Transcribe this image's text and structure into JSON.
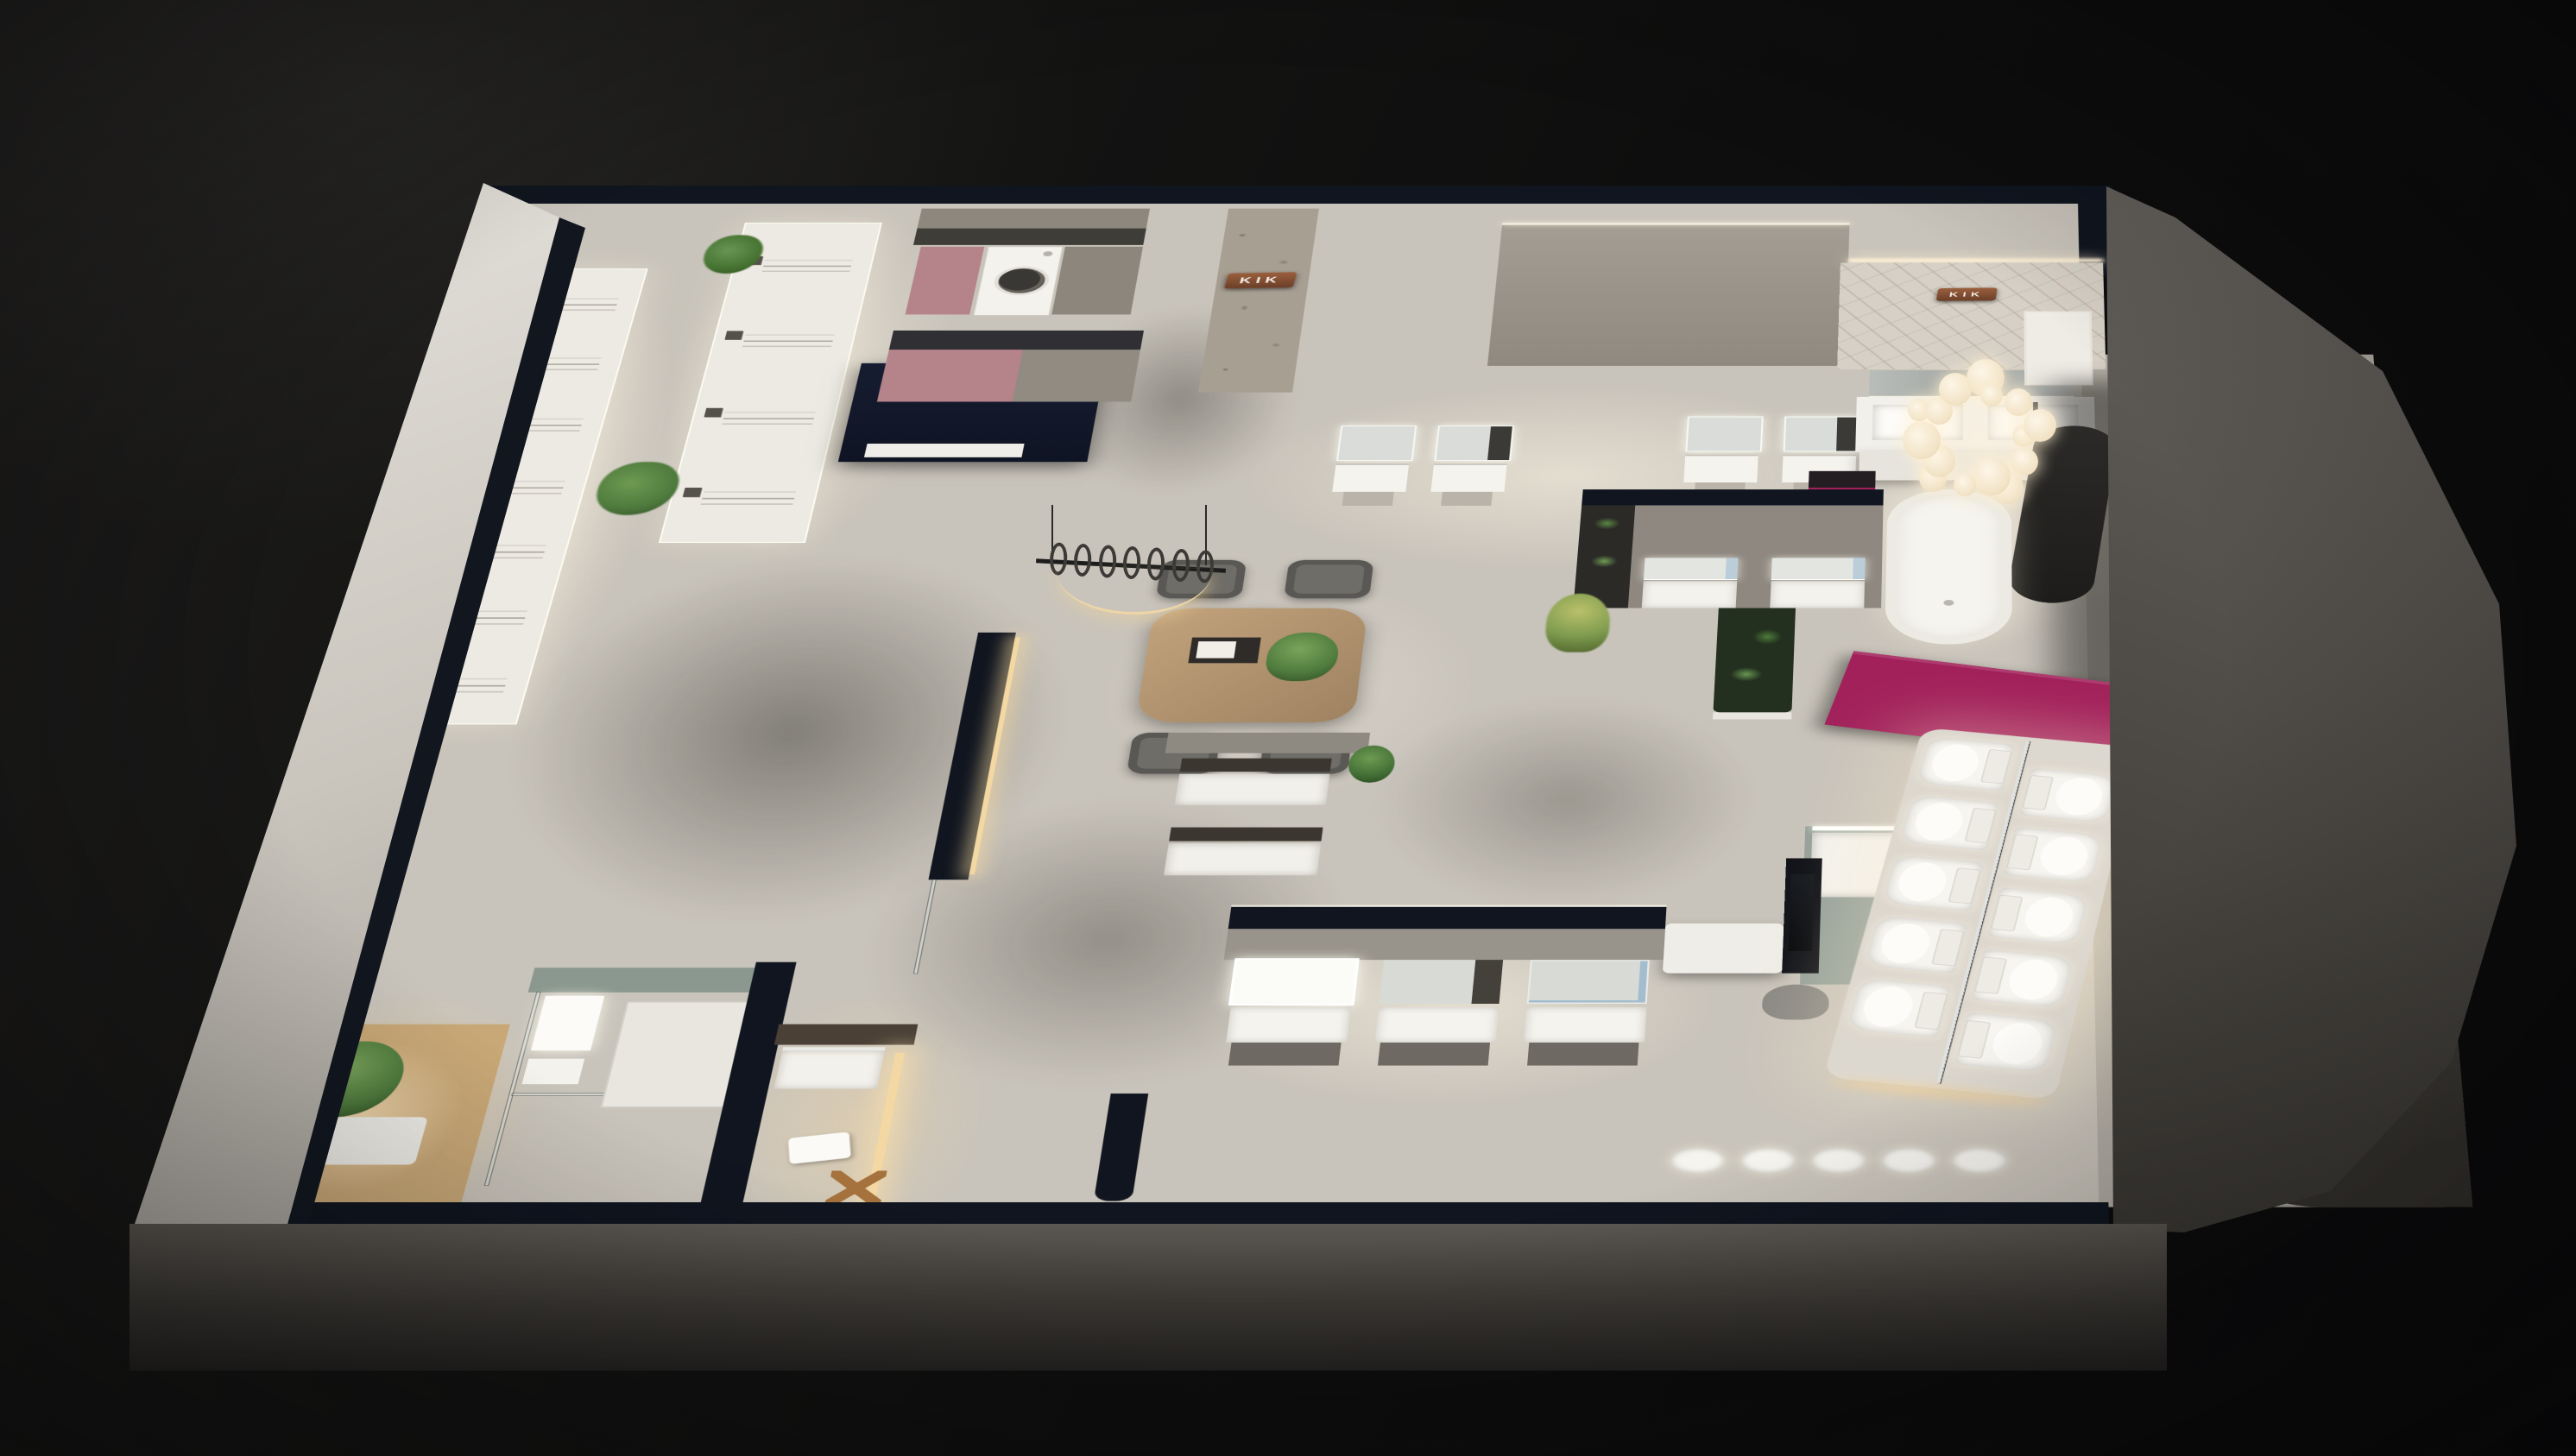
{
  "scene": {
    "description": "Night-time isometric dollhouse render of a KIK bathroom showroom",
    "background_color": "#0e0e0f",
    "signs": [
      {
        "label": "KIK",
        "location": "stone-feature-wall",
        "material": "copper plaque, white letters"
      },
      {
        "label": "KIK",
        "location": "premium-suite-marble-wall",
        "material": "copper plaque, white letters"
      }
    ],
    "palette": {
      "wall_top": "#10151f",
      "floor_light": "#c9c4bb",
      "floor_shadow": "#6f6a63",
      "accent_magenta": "#a2215b",
      "accent_pink": "#b5838a",
      "copper": "#9a5f3e",
      "plant_green": "#5d8a4a",
      "wood": "#a98b68",
      "fixture_white": "#f2efe9",
      "facade_gray": "#4b4741",
      "warm_led": "#f3d8a4",
      "sage": "#96a29a"
    },
    "areas": [
      "shower-display-hall",
      "laundry-display",
      "stone-feature-wall",
      "north-vanity-displays",
      "premium-bath-suite",
      "meeting-area",
      "central-mockup-bathrooms",
      "south-vanity-displays",
      "toilet-display-platform",
      "entry-mockup-rooms"
    ],
    "counts": {
      "shower_stations_west": 7,
      "shower_stations_aisle": 4,
      "vanity_units_per_bay": 2,
      "premium_twin_basins": 2,
      "island_vanity_units": 2,
      "mockup_vanity_units": 2,
      "south_display_vanities": 3,
      "toilets_per_row": 5,
      "toilet_rows": 2,
      "south_edge_basins": 5,
      "meeting_chairs": 4,
      "chandelier_bulbs": 15,
      "pendant_hooks": 7
    }
  }
}
